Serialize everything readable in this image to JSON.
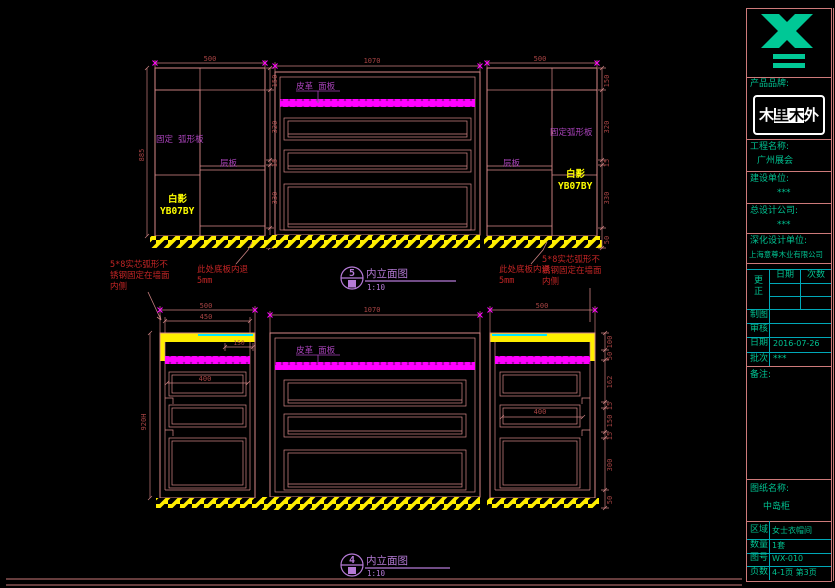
{
  "drawing": {
    "dims": {
      "tl_width": "500",
      "tl_height": "885",
      "tl_side": [
        "150",
        "320",
        "15",
        "330",
        "50"
      ],
      "tc_width": "1070",
      "tr_width": "500",
      "tr_side": [
        "150",
        "320",
        "15",
        "330",
        "50"
      ],
      "bl_width": "500",
      "bl_width2": "450",
      "bl_top_inner": "150",
      "bl_height": "920H",
      "bl_drawer": "400",
      "bc_width": "1070",
      "br_width": "500",
      "br_drawer": "400",
      "br_side": [
        "100",
        "50",
        "162",
        "15",
        "150",
        "15",
        "300",
        "50"
      ]
    },
    "labels": {
      "fixed_panel": "固定 弧形板",
      "fixed_panel2": "固定弧形板",
      "shelf": "层板",
      "material_name": "白影",
      "material_code": "YB07BY",
      "leather_panel": "皮革 面板"
    },
    "notes": {
      "steel_l1": "5*8实芯弧形不",
      "steel_l2": "锈钢固定在墙面",
      "steel_l3": "内侧",
      "recess": "此处底板内退",
      "recess_mm": "5mm"
    },
    "markers": {
      "top": {
        "num": "5",
        "title": "内立面图",
        "scale": "1:10"
      },
      "bottom": {
        "num": "4",
        "title": "内立面图",
        "scale": "1:10"
      }
    }
  },
  "titleblock": {
    "brand_label": "产品品牌:",
    "brand_logo_chars": [
      "木",
      "里",
      "木",
      "外"
    ],
    "project_label": "工程名称:",
    "project_value": "广州展会",
    "builder_label": "建设单位:",
    "builder_value": "***",
    "design_label": "总设计公司:",
    "design_value": "***",
    "deepen_label": "深化设计单位:",
    "deepen_value": "上海意尊木业有限公司",
    "rev_label": "更正",
    "rev_date": "日期",
    "rev_count": "次数",
    "draw_label": "制图",
    "check_label": "审核",
    "date_label": "日期",
    "date_value": "2016-07-26",
    "batch_label": "批次",
    "batch_value": "***",
    "remark_label": "备注:",
    "sheet_name_label": "图纸名称:",
    "sheet_name_value": "中岛柜",
    "area_label": "区域",
    "area_value": "女士衣帽间",
    "qty_label": "数量",
    "qty_value": "1套",
    "no_label": "图号",
    "no_value": "WX-010",
    "page_label": "页数",
    "page_value": "4-1页 第3页"
  }
}
